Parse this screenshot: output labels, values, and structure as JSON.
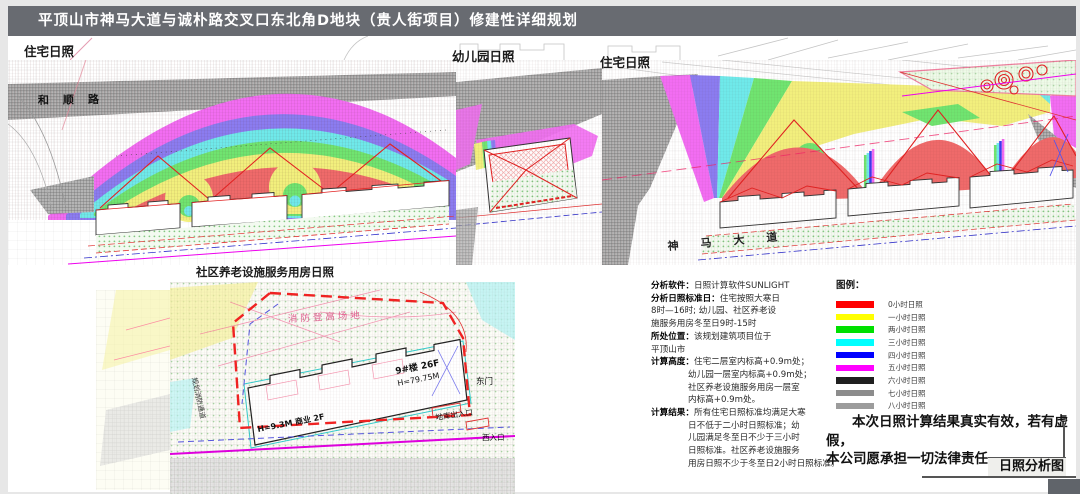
{
  "title": "平顶山市神马大道与诚朴路交叉口东北角D地块（贵人街项目）修建性详细规划",
  "panels": {
    "left_label": "住宅日照",
    "mid_label": "幼儿园日照",
    "right_label": "住宅日照",
    "detail_label": "社区养老设施服务用房日照"
  },
  "streets": {
    "left": "和顺路",
    "right": "神马大道"
  },
  "detail_map": {
    "fire_area": "消防登高场地",
    "building_no": "9#楼 26F",
    "building_height": "H=79.75M",
    "podium": "H=9.3M 商业 2F",
    "garage_entry": "地库出入口",
    "east_gate": "东门",
    "west_entry": "西入口",
    "fire_lane": "规划消防通道"
  },
  "analysis": {
    "lines": [
      {
        "b": "分析软件：",
        "t": "日照计算软件SUNLIGHT",
        "i": false
      },
      {
        "b": "分析日照标准日：",
        "t": "住宅按照大寒日",
        "i": false
      },
      {
        "b": "",
        "t": "8时—16时; 幼儿园、社区养老设",
        "i": false
      },
      {
        "b": "",
        "t": "施服务用房冬至日9时-15时",
        "i": false
      },
      {
        "b": "所处位置：",
        "t": "该规划建筑项目位于",
        "i": false
      },
      {
        "b": "",
        "t": "平顶山市",
        "i": false
      },
      {
        "b": "计算高度：",
        "t": "住宅二层室内标高+0.9m处；",
        "i": false
      },
      {
        "b": "",
        "t": "幼儿园一层室内标高+0.9m处；",
        "i": true
      },
      {
        "b": "",
        "t": "社区养老设施服务用房一层室",
        "i": true
      },
      {
        "b": "",
        "t": "内标高+0.9m处。",
        "i": true
      },
      {
        "b": "计算结果：",
        "t": "所有住宅日照标准均满足大寒",
        "i": false
      },
      {
        "b": "",
        "t": "日不低于二小时日照标准；幼",
        "i": true
      },
      {
        "b": "",
        "t": "儿园满足冬至日不少于三小时",
        "i": true
      },
      {
        "b": "",
        "t": "日照标准。社区养老设施服务",
        "i": true
      },
      {
        "b": "",
        "t": "用房日照不少于冬至日2小时日照标准。",
        "i": true
      }
    ]
  },
  "legend": {
    "title": "图例：",
    "items": [
      {
        "label": "0小时日照",
        "color": "#ff0000"
      },
      {
        "label": "一小时日照",
        "color": "#ffff00"
      },
      {
        "label": "两小时日照",
        "color": "#00e000"
      },
      {
        "label": "三小时日照",
        "color": "#00ffff"
      },
      {
        "label": "四小时日照",
        "color": "#0000ff"
      },
      {
        "label": "五小时日照",
        "color": "#ff00ff"
      },
      {
        "label": "六小时日照",
        "color": "#1f1f1f"
      },
      {
        "label": "七小时日照",
        "color": "#8c8c8c"
      },
      {
        "label": "八小时日照",
        "color": "#9c9c9c"
      }
    ]
  },
  "statement": {
    "line1": "本次日照计算结果真实有效，若有虚假，",
    "line2": "本公司愿承担一切法律责任。"
  },
  "corner_label": "日照分析图"
}
